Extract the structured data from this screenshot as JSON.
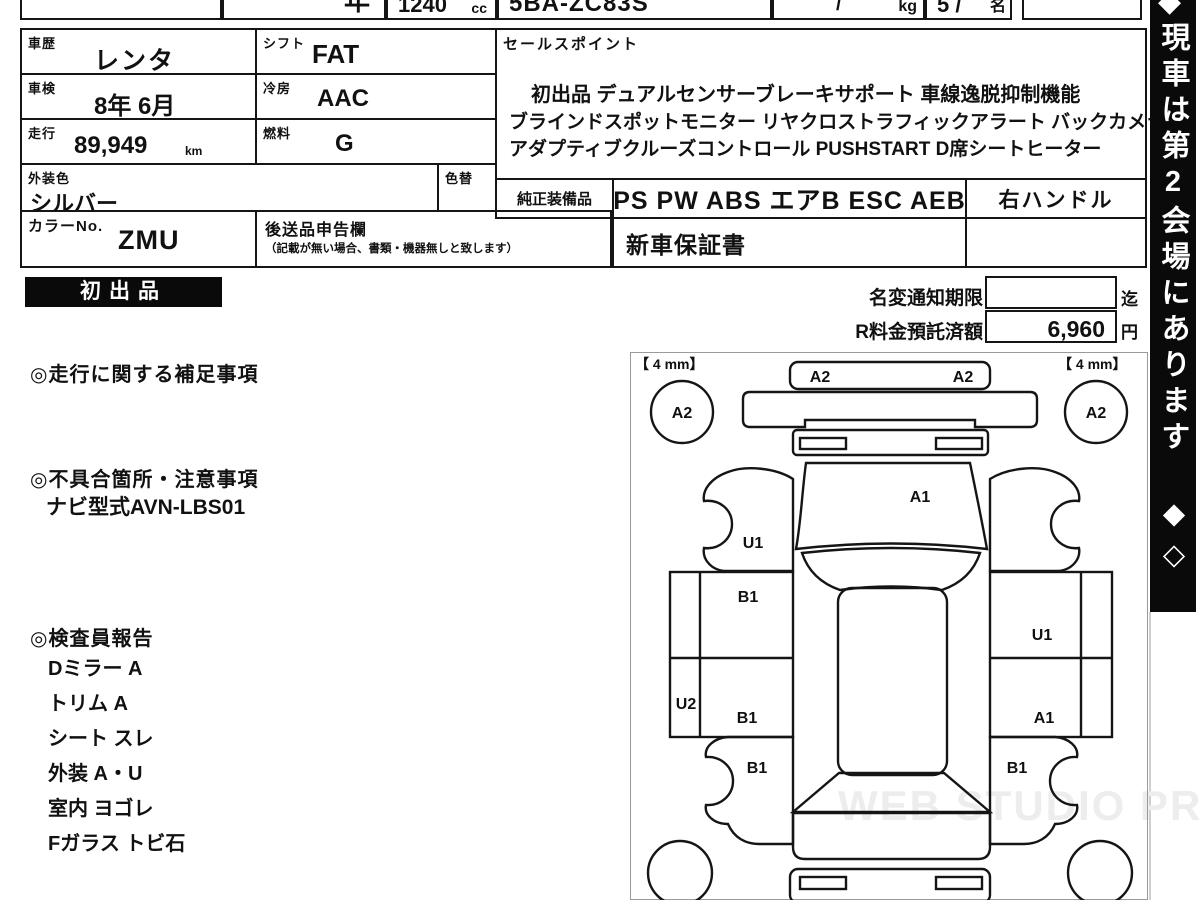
{
  "top_strip": {
    "year_fragment": "年",
    "displacement_value": "1240",
    "displacement_unit": "cc",
    "model_code": "5BA-ZC83S",
    "weight_slash": "/",
    "weight_unit": "kg",
    "capacity_value": "5 /",
    "capacity_unit": "名"
  },
  "spec": {
    "history": {
      "label": "車歴",
      "value": "レンタ"
    },
    "shift": {
      "label": "シフト",
      "value": "FAT"
    },
    "inspection": {
      "label": "車検",
      "value": "8年 6月"
    },
    "aircon": {
      "label": "冷房",
      "value": "AAC"
    },
    "mileage": {
      "label": "走行",
      "value": "89,949",
      "unit": "km"
    },
    "fuel": {
      "label": "燃料",
      "value": "G"
    },
    "exterior_color": {
      "label": "外装色",
      "value": "シルバー"
    },
    "color_change": {
      "label": "色替"
    },
    "color_no": {
      "label": "カラーNo.",
      "value": "ZMU"
    },
    "later_items": {
      "label": "後送品申告欄",
      "note": "（記載が無い場合、書類・機器無しと致します）"
    }
  },
  "sales_point": {
    "label": "セールスポイント",
    "line1": "初出品 デュアルセンサーブレーキサポート 車線逸脱抑制機能",
    "line2": "ブラインドスポットモニター リヤクロストラフィックアラート バックカメラ",
    "line3": "アダプティブクルーズコントロール PUSHSTART D席シートヒーター"
  },
  "equipment": {
    "label": "純正装備品",
    "value": "PS PW ABS エアB ESC AEB",
    "steering": "右ハンドル",
    "warranty": "新車保証書"
  },
  "badge": {
    "text": "初出品"
  },
  "notice": {
    "name_change_label": "名変通知期限",
    "name_change_value": "",
    "name_change_suffix": "迄",
    "deposit_label": "R料金預託済額",
    "deposit_value": "6,960",
    "deposit_unit": "円"
  },
  "notes": {
    "mileage_title": "◎走行に関する補足事項",
    "defect_title": "◎不具合箇所・注意事項",
    "defect_item": "ナビ型式AVN-LBS01",
    "inspector_title": "◎検査員報告",
    "inspector_items": [
      "Dミラー A",
      "トリム A",
      "シート スレ",
      "外装 A・U",
      "室内 ヨゴレ",
      "Fガラス トビ石"
    ]
  },
  "banner": {
    "text": "現車は第2会場にあります ◆◇",
    "top_mark": "◆",
    "bg": "#0a0a0a"
  },
  "diagram": {
    "tire_front_left": "【 4 mm】",
    "tire_front_right": "【 4 mm】",
    "marks": {
      "front_bumper_left": "A2",
      "front_bumper_right": "A2",
      "wheel_front_left": "A2",
      "wheel_front_right": "A2",
      "hood": "A1",
      "front_fender_left": "U1",
      "left_box_top": "B1",
      "sill_left": "U2",
      "left_box_bottom": "B1",
      "quarter_left": "B1",
      "right_box_top": "U1",
      "right_box_bottom": "A1",
      "quarter_right": "B1"
    }
  },
  "watermark": "WEB STUDIO PRO",
  "colors": {
    "line": "#151515",
    "banner_bg": "#0a0a0a",
    "badge_bg": "#0a0a0a",
    "watermark": "#ededed"
  }
}
